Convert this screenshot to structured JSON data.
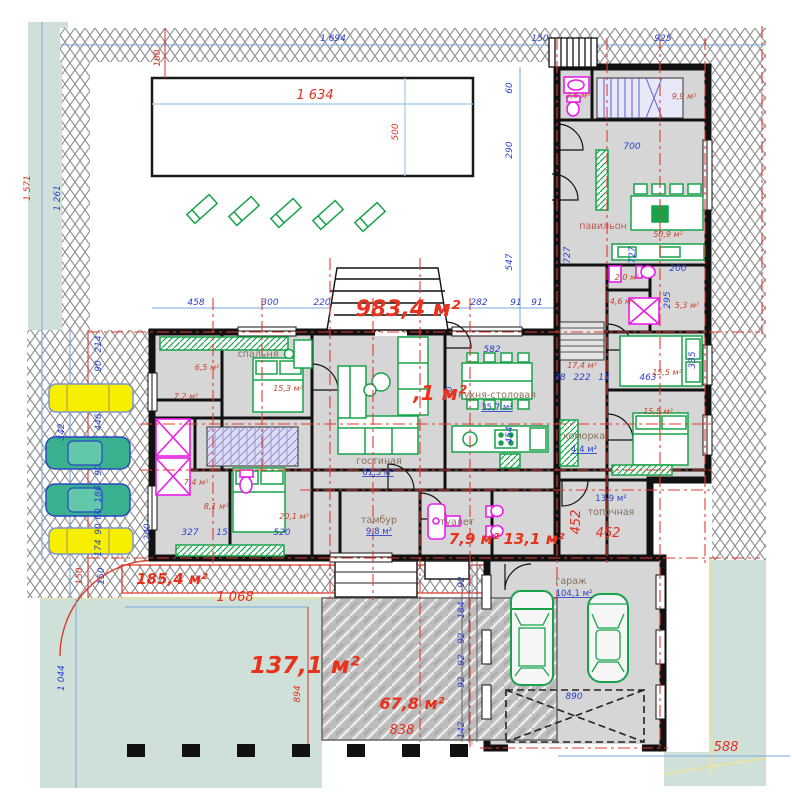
{
  "plan_title": "floor-plan",
  "rooms": {
    "names": [
      {
        "t": "павильон",
        "x": 603,
        "y": 229,
        "red": 1
      },
      {
        "t": "спальня",
        "x": 258,
        "y": 357
      },
      {
        "t": "гостиная",
        "x": 379,
        "y": 464
      },
      {
        "t": "кухня-столовая",
        "x": 497,
        "y": 398
      },
      {
        "t": "коморка",
        "x": 584,
        "y": 439
      },
      {
        "t": "тамбур",
        "x": 379,
        "y": 523
      },
      {
        "t": "туалет",
        "x": 457,
        "y": 525
      },
      {
        "t": "топочная",
        "x": 611,
        "y": 515
      },
      {
        "t": "гараж",
        "x": 571,
        "y": 584
      }
    ],
    "areas_underlined": [
      {
        "t": "61,3 м²",
        "x": 378,
        "y": 475
      },
      {
        "t": "35,7 м²",
        "x": 497,
        "y": 410
      },
      {
        "t": "4,4 м²",
        "x": 584,
        "y": 452
      },
      {
        "t": "9,8 м²",
        "x": 379,
        "y": 534
      },
      {
        "t": "104,1 м²",
        "x": 574,
        "y": 596
      },
      {
        "t": "13,9 м²",
        "x": 611,
        "y": 501,
        "u": 0
      }
    ],
    "areas_small": [
      {
        "t": "50,9 м²",
        "x": 668,
        "y": 237
      },
      {
        "t": "15,3 м²",
        "x": 288,
        "y": 391
      },
      {
        "t": "6,5 м²",
        "x": 207,
        "y": 370
      },
      {
        "t": "7,2 м²",
        "x": 186,
        "y": 399
      },
      {
        "t": "7,4 м²",
        "x": 196,
        "y": 485
      },
      {
        "t": "8,1 м²",
        "x": 216,
        "y": 509
      },
      {
        "t": "20,1 м²",
        "x": 294,
        "y": 519
      },
      {
        "t": "17,4 м²",
        "x": 582,
        "y": 368
      },
      {
        "t": "15,5 м²",
        "x": 667,
        "y": 375
      },
      {
        "t": "15,5 м²",
        "x": 658,
        "y": 414
      },
      {
        "t": "4,6 м²",
        "x": 622,
        "y": 304
      },
      {
        "t": "5,3 м²",
        "x": 687,
        "y": 308
      },
      {
        "t": "2,0 м²",
        "x": 627,
        "y": 280
      },
      {
        "t": "2,6 м²",
        "x": 578,
        "y": 98
      },
      {
        "t": "9,9 м²",
        "x": 684,
        "y": 99
      }
    ]
  },
  "site_areas": [
    {
      "t": "983,4 м²",
      "x": 408,
      "y": 316,
      "s": 22
    },
    {
      "t": ",1 м²",
      "x": 440,
      "y": 400,
      "s": 20
    },
    {
      "t": "185,4 м²",
      "x": 172,
      "y": 584,
      "s": 15
    },
    {
      "t": "137,1 м²",
      "x": 305,
      "y": 673,
      "s": 23
    },
    {
      "t": "67,8 м²",
      "x": 412,
      "y": 709,
      "s": 16
    },
    {
      "t": "7,9 м²",
      "x": 474,
      "y": 544,
      "s": 15
    },
    {
      "t": "13,1 м²",
      "x": 534,
      "y": 544,
      "s": 15
    }
  ],
  "dimensions": [
    {
      "t": "1 694",
      "x": 333,
      "y": 41,
      "c": "b"
    },
    {
      "t": "150",
      "x": 540,
      "y": 41,
      "c": "b"
    },
    {
      "t": "925",
      "x": 663,
      "y": 41,
      "c": "b"
    },
    {
      "t": "100",
      "x": 160,
      "y": 58,
      "c": "r",
      "rot": 1
    },
    {
      "t": "1 571",
      "x": 30,
      "y": 188,
      "c": "r",
      "rot": 1
    },
    {
      "t": "1 261",
      "x": 60,
      "y": 198,
      "c": "b",
      "rot": 1
    },
    {
      "t": "1 634",
      "x": 315,
      "y": 99,
      "c": "r",
      "big": 1
    },
    {
      "t": "500",
      "x": 398,
      "y": 132,
      "c": "r",
      "rot": 1
    },
    {
      "t": "60",
      "x": 512,
      "y": 88,
      "c": "b",
      "rot": 1
    },
    {
      "t": "290",
      "x": 512,
      "y": 150,
      "c": "b",
      "rot": 1
    },
    {
      "t": "547",
      "x": 512,
      "y": 262,
      "c": "b",
      "rot": 1
    },
    {
      "t": "454",
      "x": 512,
      "y": 435,
      "c": "b",
      "rot": 1
    },
    {
      "t": "458",
      "x": 196,
      "y": 305,
      "c": "b"
    },
    {
      "t": "300",
      "x": 270,
      "y": 305,
      "c": "b"
    },
    {
      "t": "220",
      "x": 322,
      "y": 305,
      "c": "b"
    },
    {
      "t": "282",
      "x": 479,
      "y": 305,
      "c": "b"
    },
    {
      "t": "91",
      "x": 516,
      "y": 305,
      "c": "b"
    },
    {
      "t": "91",
      "x": 537,
      "y": 305,
      "c": "b"
    },
    {
      "t": "700",
      "x": 632,
      "y": 149,
      "c": "b"
    },
    {
      "t": "727",
      "x": 570,
      "y": 255,
      "c": "b",
      "rot": 1
    },
    {
      "t": "727",
      "x": 635,
      "y": 255,
      "c": "b",
      "rot": 1
    },
    {
      "t": "200",
      "x": 678,
      "y": 271,
      "c": "b"
    },
    {
      "t": "295",
      "x": 670,
      "y": 300,
      "c": "b",
      "rot": 1
    },
    {
      "t": "335",
      "x": 695,
      "y": 360,
      "c": "b",
      "rot": 1
    },
    {
      "t": "463",
      "x": 648,
      "y": 380,
      "c": "b"
    },
    {
      "t": "15",
      "x": 604,
      "y": 380,
      "c": "b"
    },
    {
      "t": "222",
      "x": 582,
      "y": 380,
      "c": "b"
    },
    {
      "t": "38",
      "x": 560,
      "y": 380,
      "c": "b"
    },
    {
      "t": "582",
      "x": 492,
      "y": 352,
      "c": "b"
    },
    {
      "t": "60",
      "x": 452,
      "y": 392,
      "c": "b",
      "rot": 1
    },
    {
      "t": "214",
      "x": 101,
      "y": 344,
      "c": "b",
      "rot": 1
    },
    {
      "t": "90",
      "x": 101,
      "y": 366,
      "c": "b",
      "rot": 1
    },
    {
      "t": "446",
      "x": 101,
      "y": 422,
      "c": "b",
      "rot": 1
    },
    {
      "t": "342",
      "x": 64,
      "y": 432,
      "c": "b",
      "rot": 1
    },
    {
      "t": "90",
      "x": 101,
      "y": 470,
      "c": "b",
      "rot": 1
    },
    {
      "t": "186",
      "x": 101,
      "y": 494,
      "c": "b",
      "rot": 1
    },
    {
      "t": "60",
      "x": 101,
      "y": 514,
      "c": "b",
      "rot": 1
    },
    {
      "t": "90",
      "x": 101,
      "y": 529,
      "c": "b",
      "rot": 1
    },
    {
      "t": "174",
      "x": 101,
      "y": 548,
      "c": "b",
      "rot": 1
    },
    {
      "t": "150",
      "x": 82,
      "y": 576,
      "c": "r",
      "rot": 1
    },
    {
      "t": "150",
      "x": 104,
      "y": 576,
      "c": "b",
      "rot": 1
    },
    {
      "t": "1 044",
      "x": 64,
      "y": 678,
      "c": "b",
      "rot": 1
    },
    {
      "t": "1 068",
      "x": 235,
      "y": 601,
      "c": "r",
      "big": 1
    },
    {
      "t": "894",
      "x": 300,
      "y": 694,
      "c": "r",
      "rot": 1
    },
    {
      "t": "327",
      "x": 190,
      "y": 535,
      "c": "b"
    },
    {
      "t": "15",
      "x": 222,
      "y": 535,
      "c": "b"
    },
    {
      "t": "520",
      "x": 282,
      "y": 535,
      "c": "b"
    },
    {
      "t": "240",
      "x": 150,
      "y": 532,
      "c": "b",
      "rot": 1
    },
    {
      "t": "92",
      "x": 464,
      "y": 582,
      "c": "b",
      "rot": 1
    },
    {
      "t": "184",
      "x": 464,
      "y": 610,
      "c": "b",
      "rot": 1
    },
    {
      "t": "92",
      "x": 464,
      "y": 638,
      "c": "b",
      "rot": 1
    },
    {
      "t": "92",
      "x": 464,
      "y": 660,
      "c": "b",
      "rot": 1
    },
    {
      "t": "92",
      "x": 464,
      "y": 682,
      "c": "b",
      "rot": 1
    },
    {
      "t": "142",
      "x": 464,
      "y": 730,
      "c": "b",
      "rot": 1
    },
    {
      "t": "838",
      "x": 402,
      "y": 734,
      "c": "r",
      "big": 1
    },
    {
      "t": "452",
      "x": 580,
      "y": 522,
      "c": "r",
      "rot": 1,
      "big": 1
    },
    {
      "t": "462",
      "x": 608,
      "y": 537,
      "c": "r",
      "big": 1
    },
    {
      "t": "588",
      "x": 726,
      "y": 751,
      "c": "r",
      "big": 1
    },
    {
      "t": "890",
      "x": 574,
      "y": 699,
      "c": "b"
    }
  ],
  "colors": {
    "wall": "#111111",
    "room_fill": "#d6d6d6",
    "furniture": "#18a34a",
    "plumbing": "#e91ee9",
    "dim_blue": "#2b3fd0",
    "dim_red": "#e03020",
    "lawn": "#cfe0d8",
    "car_yellow": "#f7ee00",
    "car_green": "#39b08e"
  }
}
